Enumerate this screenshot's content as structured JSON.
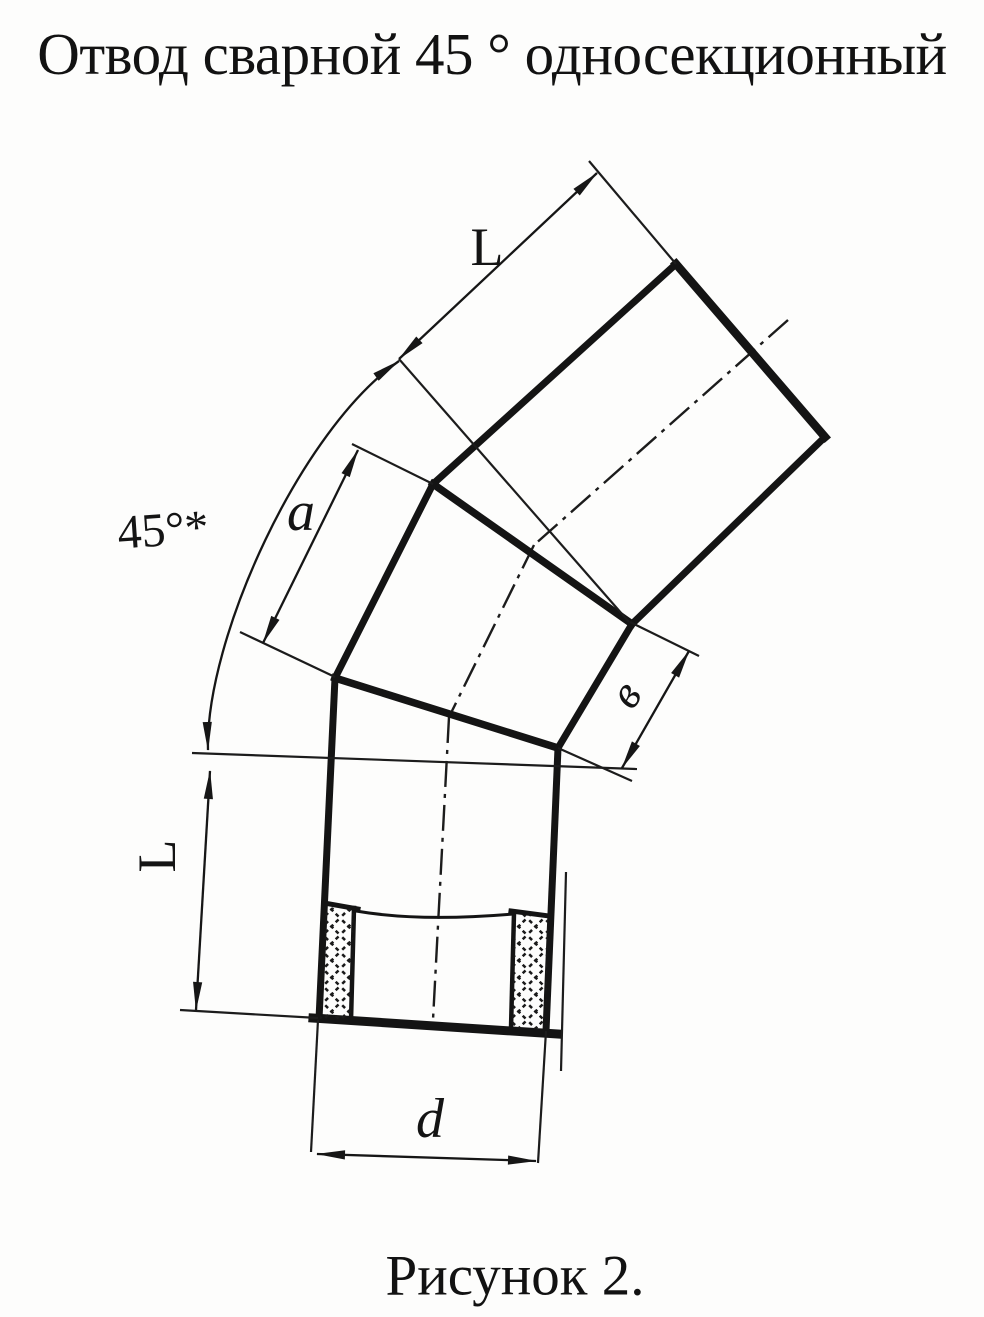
{
  "page": {
    "background": "#fdfdfc",
    "ink_color": "#161616"
  },
  "title": "Отвод сварной 45 ° односекционный",
  "figure": {
    "caption": "Рисунок 2.",
    "type": "technical-drawing",
    "subject": "welded 45-degree single-section pipe elbow, side view with weld hatching",
    "labels": {
      "length_top": "L",
      "section_edge": "a",
      "angle": "45°*",
      "section_width": "в",
      "length_left": "L",
      "diameter": "d"
    }
  }
}
